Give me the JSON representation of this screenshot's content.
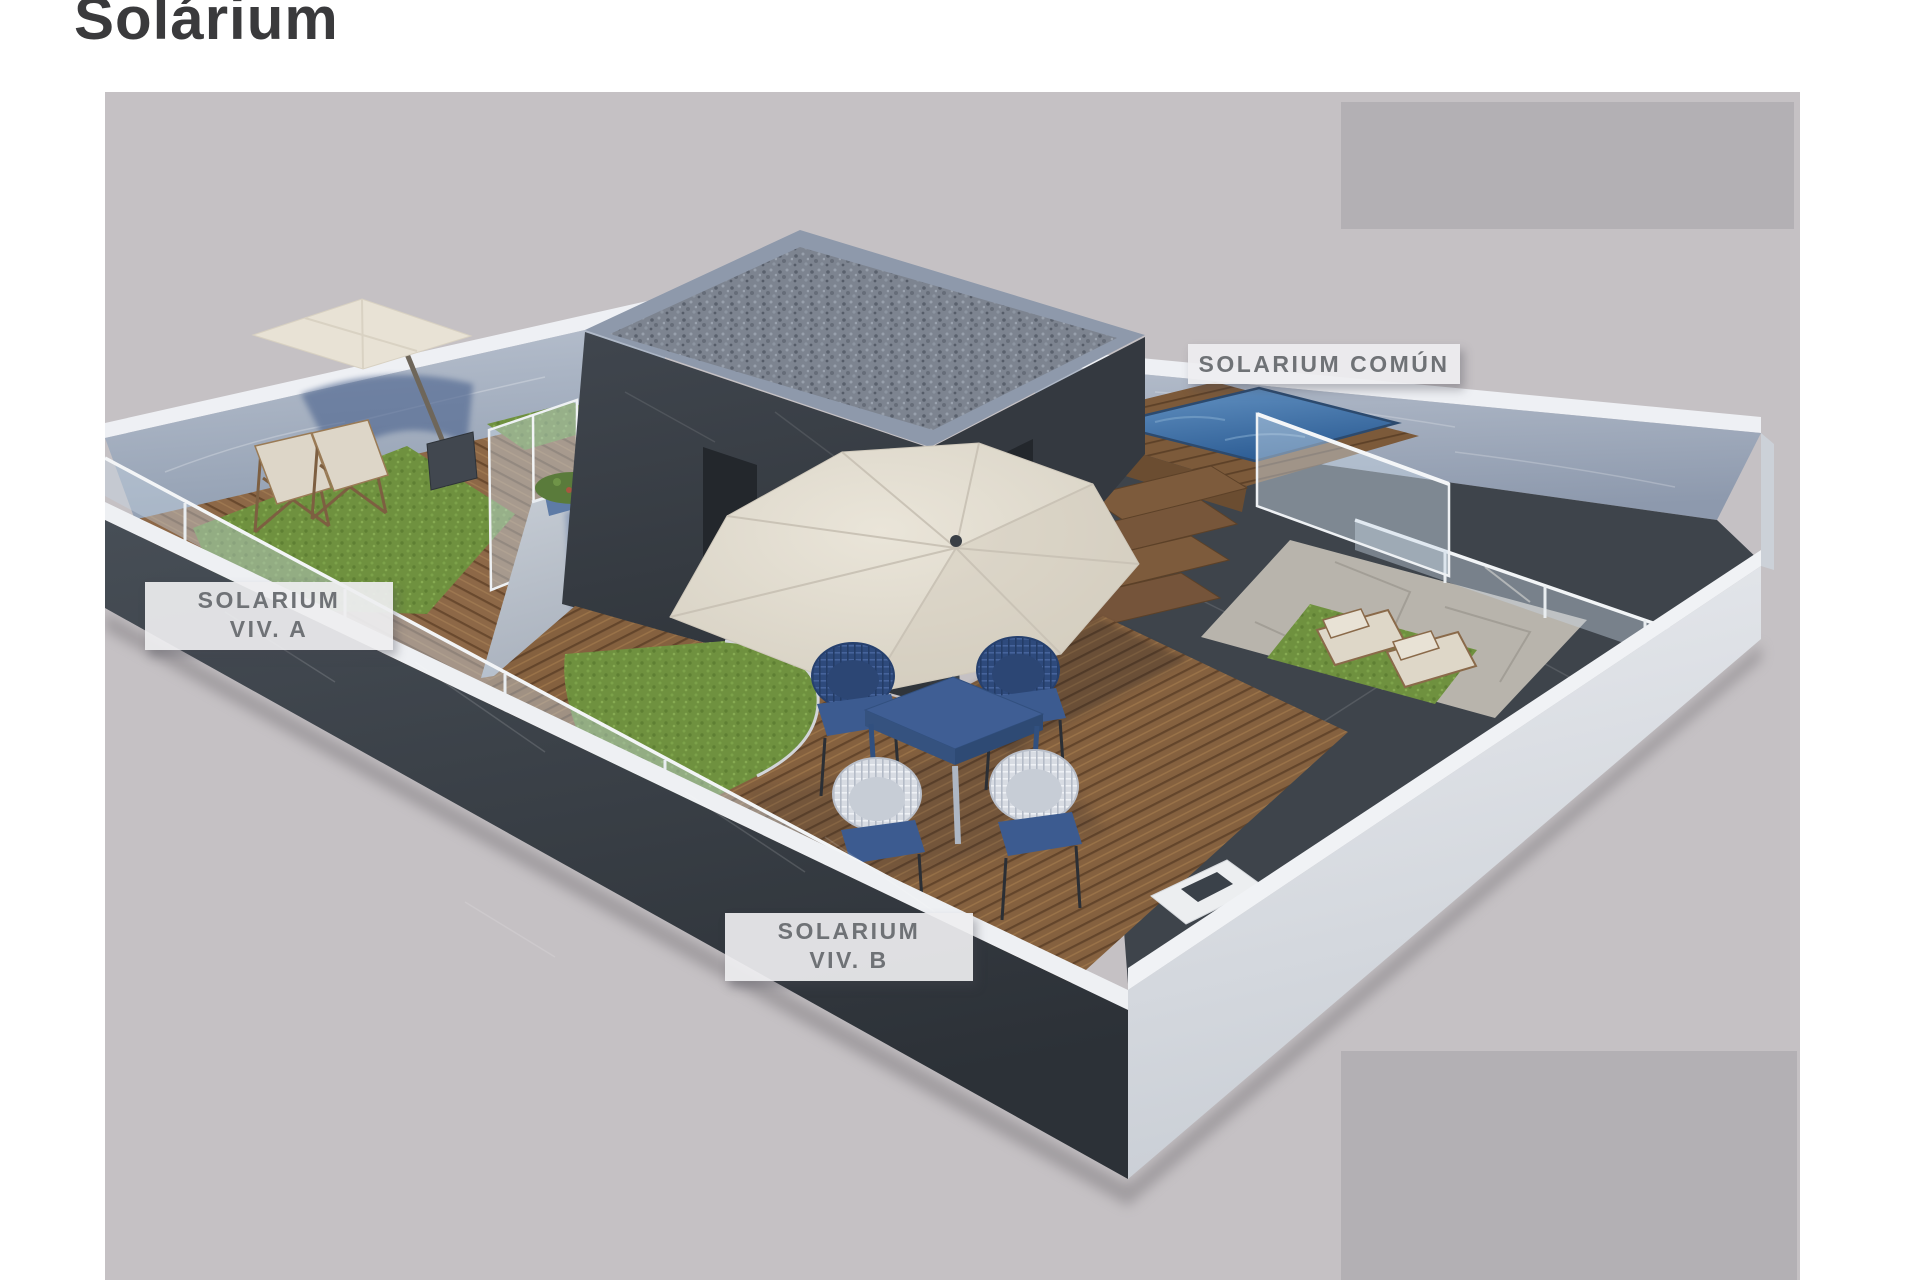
{
  "page": {
    "title": "Solárium"
  },
  "render": {
    "labels": {
      "common": "SOLARIUM COMÚN",
      "viv_a": {
        "line1": "SOLARIUM",
        "line2": "VIV. A"
      },
      "viv_b": {
        "line1": "SOLARIUM",
        "line2": "VIV. B"
      }
    },
    "palette": {
      "canvas_background": "#c5c1c4",
      "masked_region": "#b3b0b4",
      "title_text": "#3a3a3c",
      "label_text": "#6f7276",
      "label_background": "#eeeef0",
      "dark_marble_wall": "#3a4046",
      "light_marble_wall": "#a9b2c2",
      "white_wall": "#e3e5e9",
      "wood_deck": "#8d6847",
      "grass": "#6f913f",
      "pool_water": "#3f72ab",
      "umbrella_canvas": "#e4ded1",
      "blue_furniture": "#3c5b90",
      "gravel_roof": "#7d8490"
    }
  }
}
